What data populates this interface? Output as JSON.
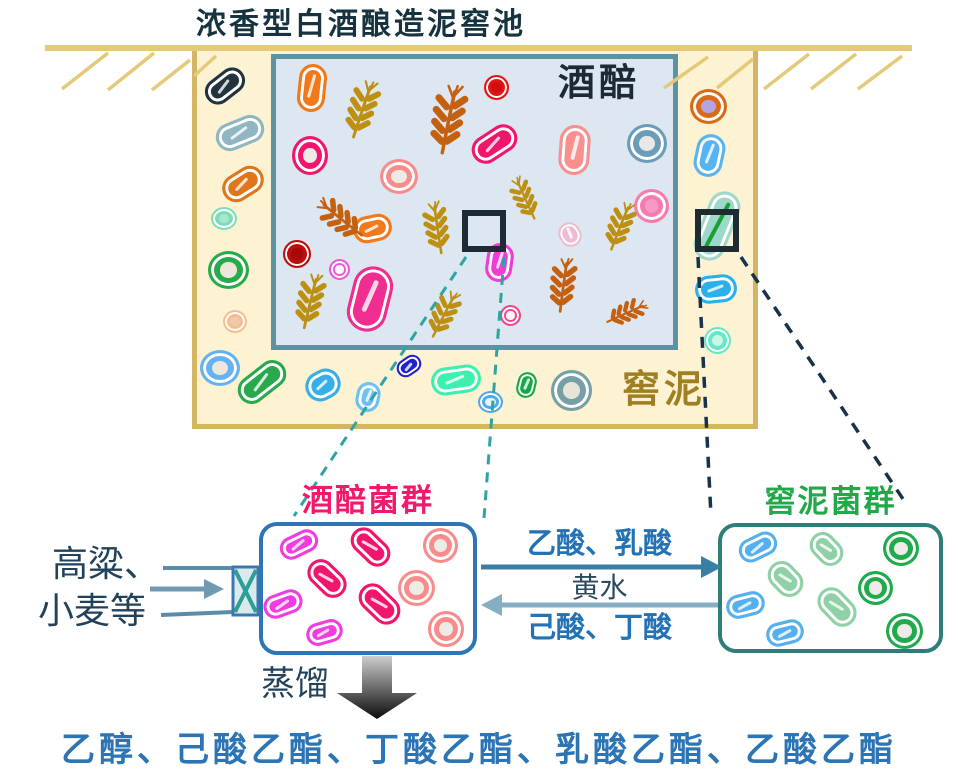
{
  "title": "浓香型白酒酿造泥窖池",
  "pit": {
    "grain_label": "酒醅",
    "mud_label": "窖泥"
  },
  "detail_left": {
    "label": "酒醅菌群"
  },
  "detail_right": {
    "label": "窖泥菌群"
  },
  "input": {
    "line1": "高粱、",
    "line2": "小麦等"
  },
  "flows": {
    "to_right": "乙酸、乳酸",
    "middle": "黄水",
    "to_left": "己酸、丁酸"
  },
  "distillation": {
    "label": "蒸馏"
  },
  "products": {
    "text": "乙醇、己酸乙酯、丁酸乙酯、乳酸乙酯、乙酸乙酯"
  },
  "icons": {
    "wheat": "wheat-ear glyph drawn in gold/rust strokes",
    "rod_bacterium": "capsule with double outline and highlight slash",
    "coccus_bacterium": "ring/donut circle with double outline",
    "valve": "rectangle with X (inlet valve)"
  },
  "colors": {
    "title_text": "#16333f",
    "ground_line": "#e4c979",
    "pit_fill": "#fdf3d2",
    "pit_border": "#d3b564",
    "grain_area_fill": "#dde7f1",
    "grain_area_border": "#5c93a3",
    "grain_label_text": "#1d2a32",
    "mud_label_text": "#a07f22",
    "zoom_square": "#1e2b33",
    "dashed_grain_connector": "#2fa3a3",
    "dashed_mud_connector": "#17324a",
    "left_box_border": "#2e75b6",
    "left_box_label": "#f2196d",
    "right_box_border": "#2f7d78",
    "right_box_label": "#21a849",
    "flow_text": "#2272b5",
    "huangshui_text": "#2c4a5e",
    "arrow_to_right": "#3b7ea3",
    "arrow_to_left": "#85aec2",
    "input_lines": "#5b8ba8",
    "input_text": "#22415a",
    "products_text": "#2d74b4",
    "wheat_gold": "#bd9012",
    "wheat_rust": "#c4600f"
  }
}
